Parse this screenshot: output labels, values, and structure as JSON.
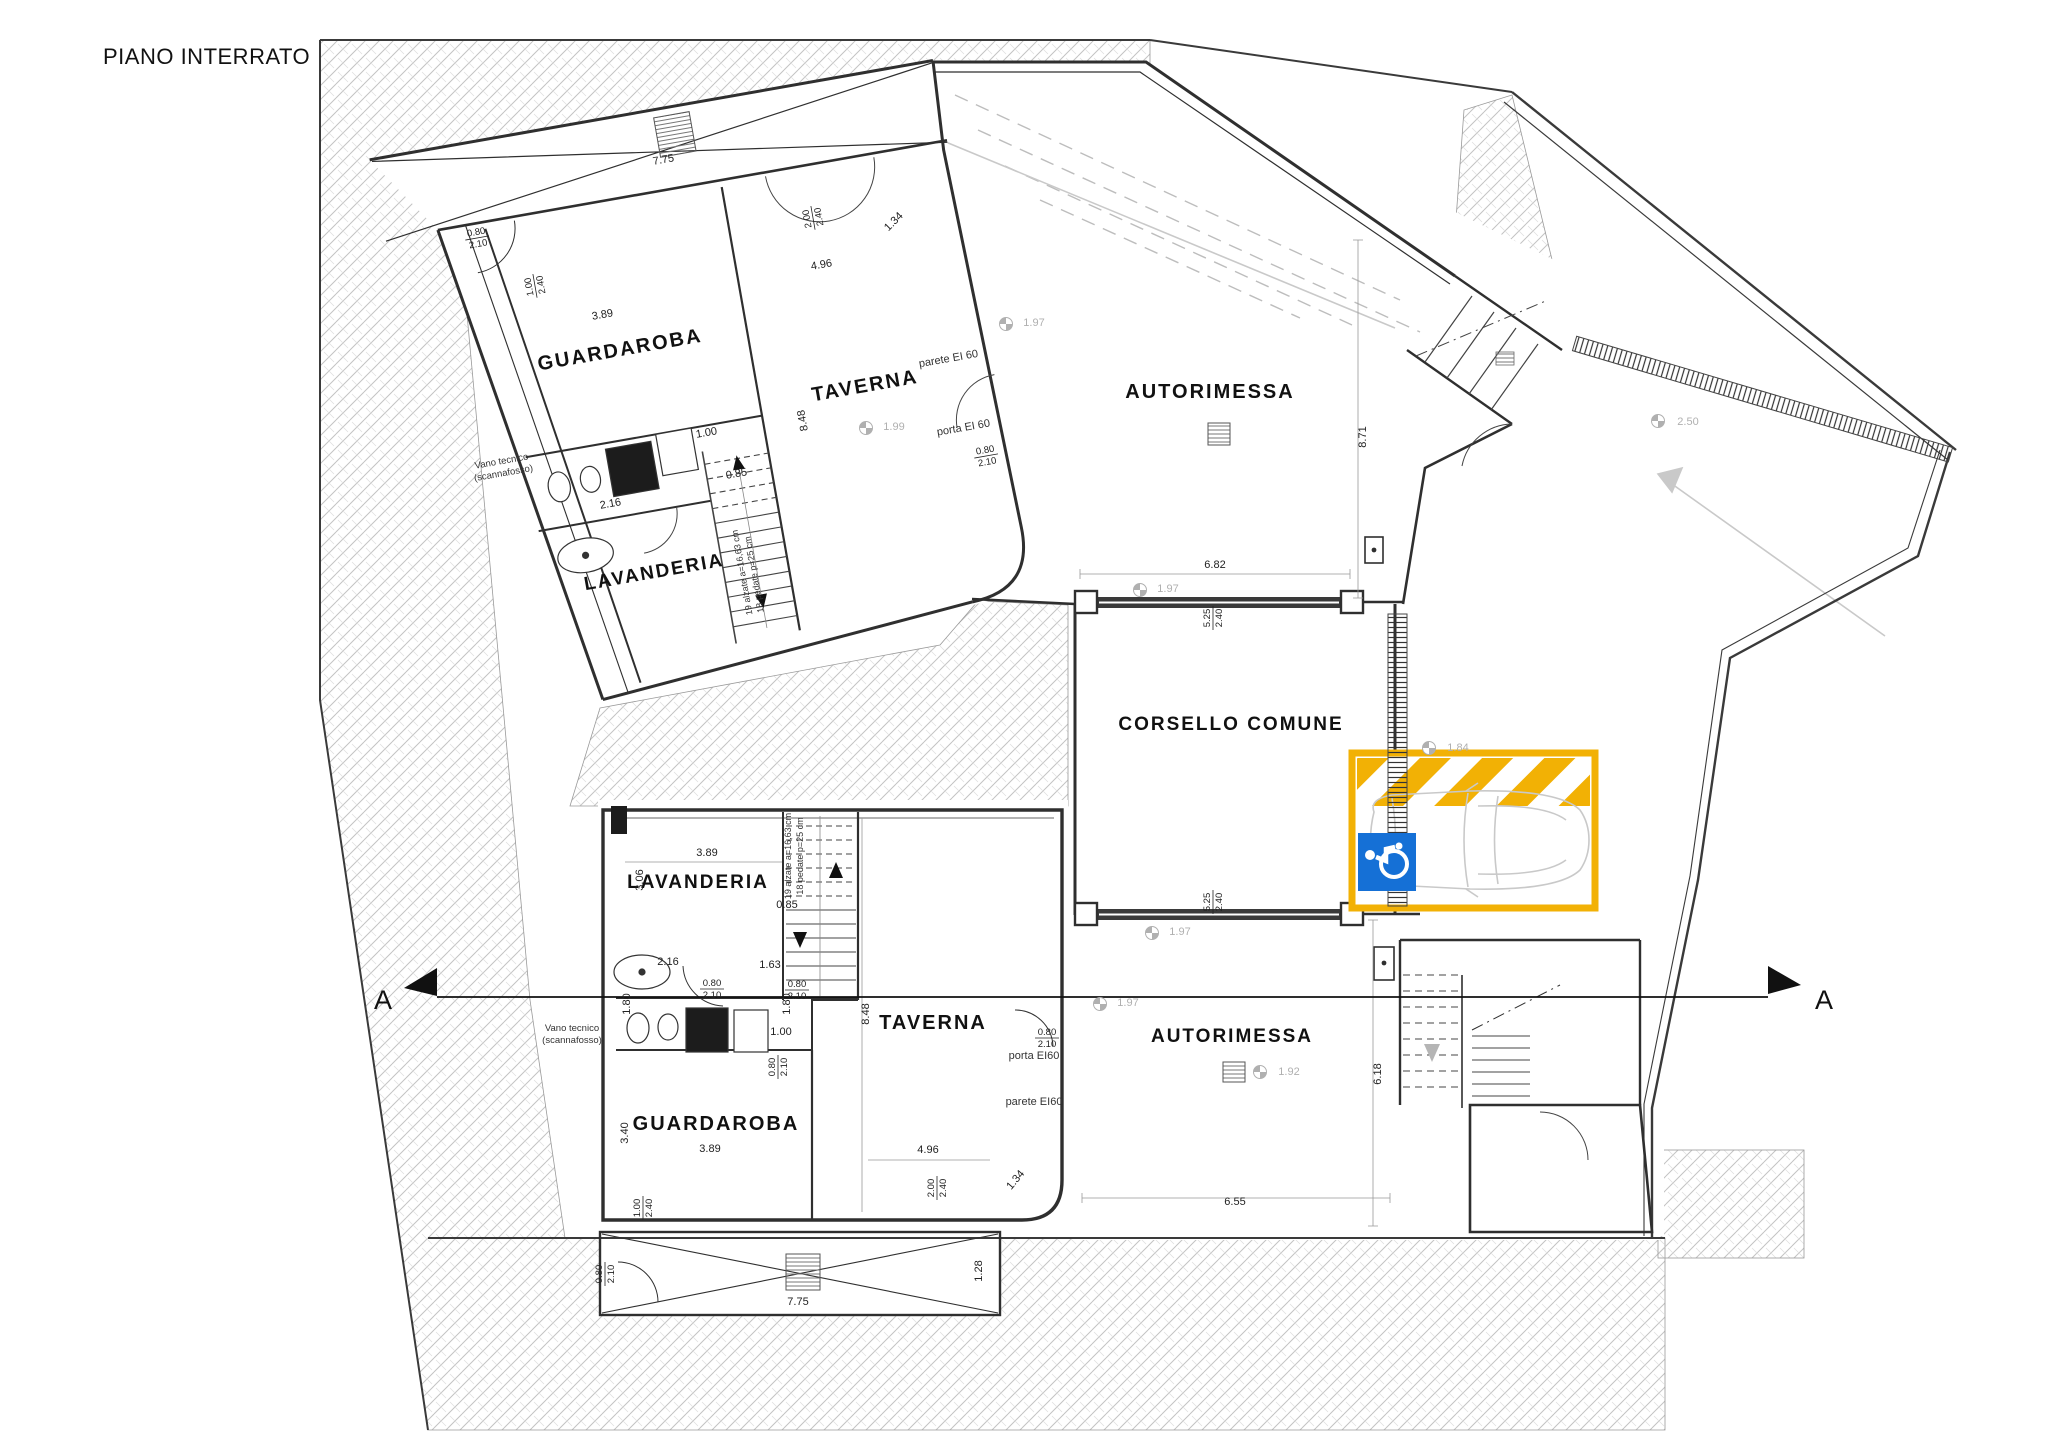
{
  "title": "PIANO INTERRATO",
  "colors": {
    "wall": "#2f2f2f",
    "thin": "#555555",
    "ground_line": "#b5b5b5",
    "dim": "#222222",
    "level_gray": "#b0b0b0",
    "highlight_yellow": "#F2B105",
    "sign_blue": "#1570D6",
    "car_gray": "#c9c9c9"
  },
  "section_markers": [
    {
      "text": "A",
      "x": 383,
      "y": 1009
    },
    {
      "text": "A",
      "x": 1824,
      "y": 1009
    }
  ],
  "rooms": [
    {
      "text": "GUARDAROBA",
      "x": 621,
      "y": 356,
      "r": -10,
      "s": 20
    },
    {
      "text": "TAVERNA",
      "x": 866,
      "y": 392,
      "r": -10,
      "s": 20
    },
    {
      "text": "LAVANDERIA",
      "x": 655,
      "y": 578,
      "r": -10,
      "s": 19
    },
    {
      "text": "AUTORIMESSA",
      "x": 1210,
      "y": 398,
      "r": 0,
      "s": 20
    },
    {
      "text": "CORSELLO COMUNE",
      "x": 1231,
      "y": 730,
      "r": 0,
      "s": 19
    },
    {
      "text": "LAVANDERIA",
      "x": 698,
      "y": 888,
      "r": 0,
      "s": 19
    },
    {
      "text": "GUARDAROBA",
      "x": 716,
      "y": 1130,
      "r": 0,
      "s": 20
    },
    {
      "text": "TAVERNA",
      "x": 933,
      "y": 1029,
      "r": 0,
      "s": 20
    },
    {
      "text": "AUTORIMESSA",
      "x": 1232,
      "y": 1042,
      "r": 0,
      "s": 19
    }
  ],
  "notes": [
    {
      "text": "parete EI 60",
      "x": 949,
      "y": 362,
      "r": -10,
      "s": 11
    },
    {
      "text": "porta EI 60",
      "x": 964,
      "y": 431,
      "r": -10,
      "s": 11
    },
    {
      "text": "porta EI60",
      "x": 1034,
      "y": 1059,
      "r": 0,
      "s": 11
    },
    {
      "text": "parete EI60",
      "x": 1034,
      "y": 1105,
      "r": 0,
      "s": 11
    },
    {
      "text": "Vano tecnico",
      "x": 502,
      "y": 464,
      "r": -10,
      "s": 9.5
    },
    {
      "text": "(scannafosso)",
      "x": 504,
      "y": 476,
      "r": -10,
      "s": 9.5
    },
    {
      "text": "Vano tecnico",
      "x": 572,
      "y": 1031,
      "r": 0,
      "s": 9.5
    },
    {
      "text": "(scannafosso)",
      "x": 572,
      "y": 1043,
      "r": 0,
      "s": 9.5
    },
    {
      "text": "19 alzate a=16,63 cm",
      "x": 791,
      "y": 856,
      "r": -90,
      "s": 9
    },
    {
      "text": "18 pedate p=25 cm",
      "x": 803,
      "y": 856,
      "r": -90,
      "s": 9
    },
    {
      "text": "19 alzate a=16,63 cm",
      "x": 745,
      "y": 572,
      "r": -100,
      "s": 9
    },
    {
      "text": "18 pedate p=25 cm",
      "x": 757,
      "y": 574,
      "r": -100,
      "s": 9
    }
  ],
  "dims": [
    {
      "text": "7.75",
      "x": 664,
      "y": 163,
      "r": -10
    },
    {
      "text": "3.89",
      "x": 603,
      "y": 318,
      "r": -10
    },
    {
      "text": "4.96",
      "x": 822,
      "y": 268,
      "r": -10
    },
    {
      "text": "1.34",
      "x": 896,
      "y": 224,
      "r": -45
    },
    {
      "text": "2.00/2.40",
      "x": 812,
      "y": 218,
      "r": -100,
      "f": true
    },
    {
      "text": "1.00/2.40",
      "x": 534,
      "y": 286,
      "r": -100,
      "f": true
    },
    {
      "text": "0.80/2.10",
      "x": 477,
      "y": 237,
      "r": -10,
      "f": true
    },
    {
      "text": "0.80/2.10",
      "x": 986,
      "y": 455,
      "r": -10,
      "f": true
    },
    {
      "text": "1.00",
      "x": 707,
      "y": 436,
      "r": -10
    },
    {
      "text": "2.16",
      "x": 611,
      "y": 507,
      "r": -10
    },
    {
      "text": "0.85",
      "x": 737,
      "y": 477,
      "r": -10
    },
    {
      "text": "8.48",
      "x": 806,
      "y": 420,
      "r": -100
    },
    {
      "text": "8.71",
      "x": 1366,
      "y": 437,
      "r": -90
    },
    {
      "text": "6.82",
      "x": 1215,
      "y": 568,
      "r": 0
    },
    {
      "text": "5.25/2.40",
      "x": 1212,
      "y": 618,
      "r": -90,
      "f": true
    },
    {
      "text": "5.25/2.40",
      "x": 1212,
      "y": 902,
      "r": -90,
      "f": true
    },
    {
      "text": "6.55",
      "x": 1235,
      "y": 1205,
      "r": 0
    },
    {
      "text": "6.18",
      "x": 1381,
      "y": 1074,
      "r": -90
    },
    {
      "text": "3.89",
      "x": 707,
      "y": 856,
      "r": 0
    },
    {
      "text": "3.06",
      "x": 643,
      "y": 880,
      "r": -90
    },
    {
      "text": "2.16",
      "x": 668,
      "y": 965,
      "r": 0
    },
    {
      "text": "1.63",
      "x": 770,
      "y": 968,
      "r": 0
    },
    {
      "text": "0.80/2.10",
      "x": 712,
      "y": 988,
      "r": 0,
      "f": true
    },
    {
      "text": "0.80/2.10",
      "x": 797,
      "y": 989,
      "r": 0,
      "f": true
    },
    {
      "text": "0.80/2.10",
      "x": 1047,
      "y": 1037,
      "r": 0,
      "f": true
    },
    {
      "text": "1.80",
      "x": 630,
      "y": 1004,
      "r": -90
    },
    {
      "text": "1.80",
      "x": 790,
      "y": 1004,
      "r": -90
    },
    {
      "text": "1.00",
      "x": 781,
      "y": 1035,
      "r": 0
    },
    {
      "text": "0.80/2.10",
      "x": 777,
      "y": 1067,
      "r": -90,
      "f": true
    },
    {
      "text": "0.85",
      "x": 787,
      "y": 908,
      "r": 0
    },
    {
      "text": "3.40",
      "x": 628,
      "y": 1133,
      "r": -90
    },
    {
      "text": "3.89",
      "x": 710,
      "y": 1152,
      "r": 0
    },
    {
      "text": "4.96",
      "x": 928,
      "y": 1153,
      "r": 0
    },
    {
      "text": "8.48",
      "x": 869,
      "y": 1014,
      "r": -90
    },
    {
      "text": "2.00/2.40",
      "x": 936,
      "y": 1188,
      "r": -90,
      "f": true
    },
    {
      "text": "1.34",
      "x": 1018,
      "y": 1182,
      "r": -50
    },
    {
      "text": "1.00/2.40",
      "x": 642,
      "y": 1208,
      "r": -90,
      "f": true
    },
    {
      "text": "0.80/2.10",
      "x": 604,
      "y": 1274,
      "r": -90,
      "f": true
    },
    {
      "text": "7.75",
      "x": 798,
      "y": 1305,
      "r": 0
    },
    {
      "text": "1.28",
      "x": 982,
      "y": 1271,
      "r": -90
    }
  ],
  "levels": [
    {
      "text": "1.99",
      "x": 888,
      "y": 426,
      "sx": 866,
      "sy": 428
    },
    {
      "text": "1.97",
      "x": 1028,
      "y": 322,
      "sx": 1006,
      "sy": 324
    },
    {
      "text": "1.97",
      "x": 1162,
      "y": 588,
      "sx": 1140,
      "sy": 590
    },
    {
      "text": "1.84",
      "x": 1452,
      "y": 747,
      "sx": 1429,
      "sy": 748
    },
    {
      "text": "1.97",
      "x": 1174,
      "y": 931,
      "sx": 1152,
      "sy": 933
    },
    {
      "text": "1.97",
      "x": 1122,
      "y": 1002,
      "sx": 1100,
      "sy": 1004
    },
    {
      "text": "1.92",
      "x": 1283,
      "y": 1071,
      "sx": 1260,
      "sy": 1072
    },
    {
      "text": "2.50",
      "x": 1682,
      "y": 421,
      "sx": 1658,
      "sy": 421
    }
  ]
}
